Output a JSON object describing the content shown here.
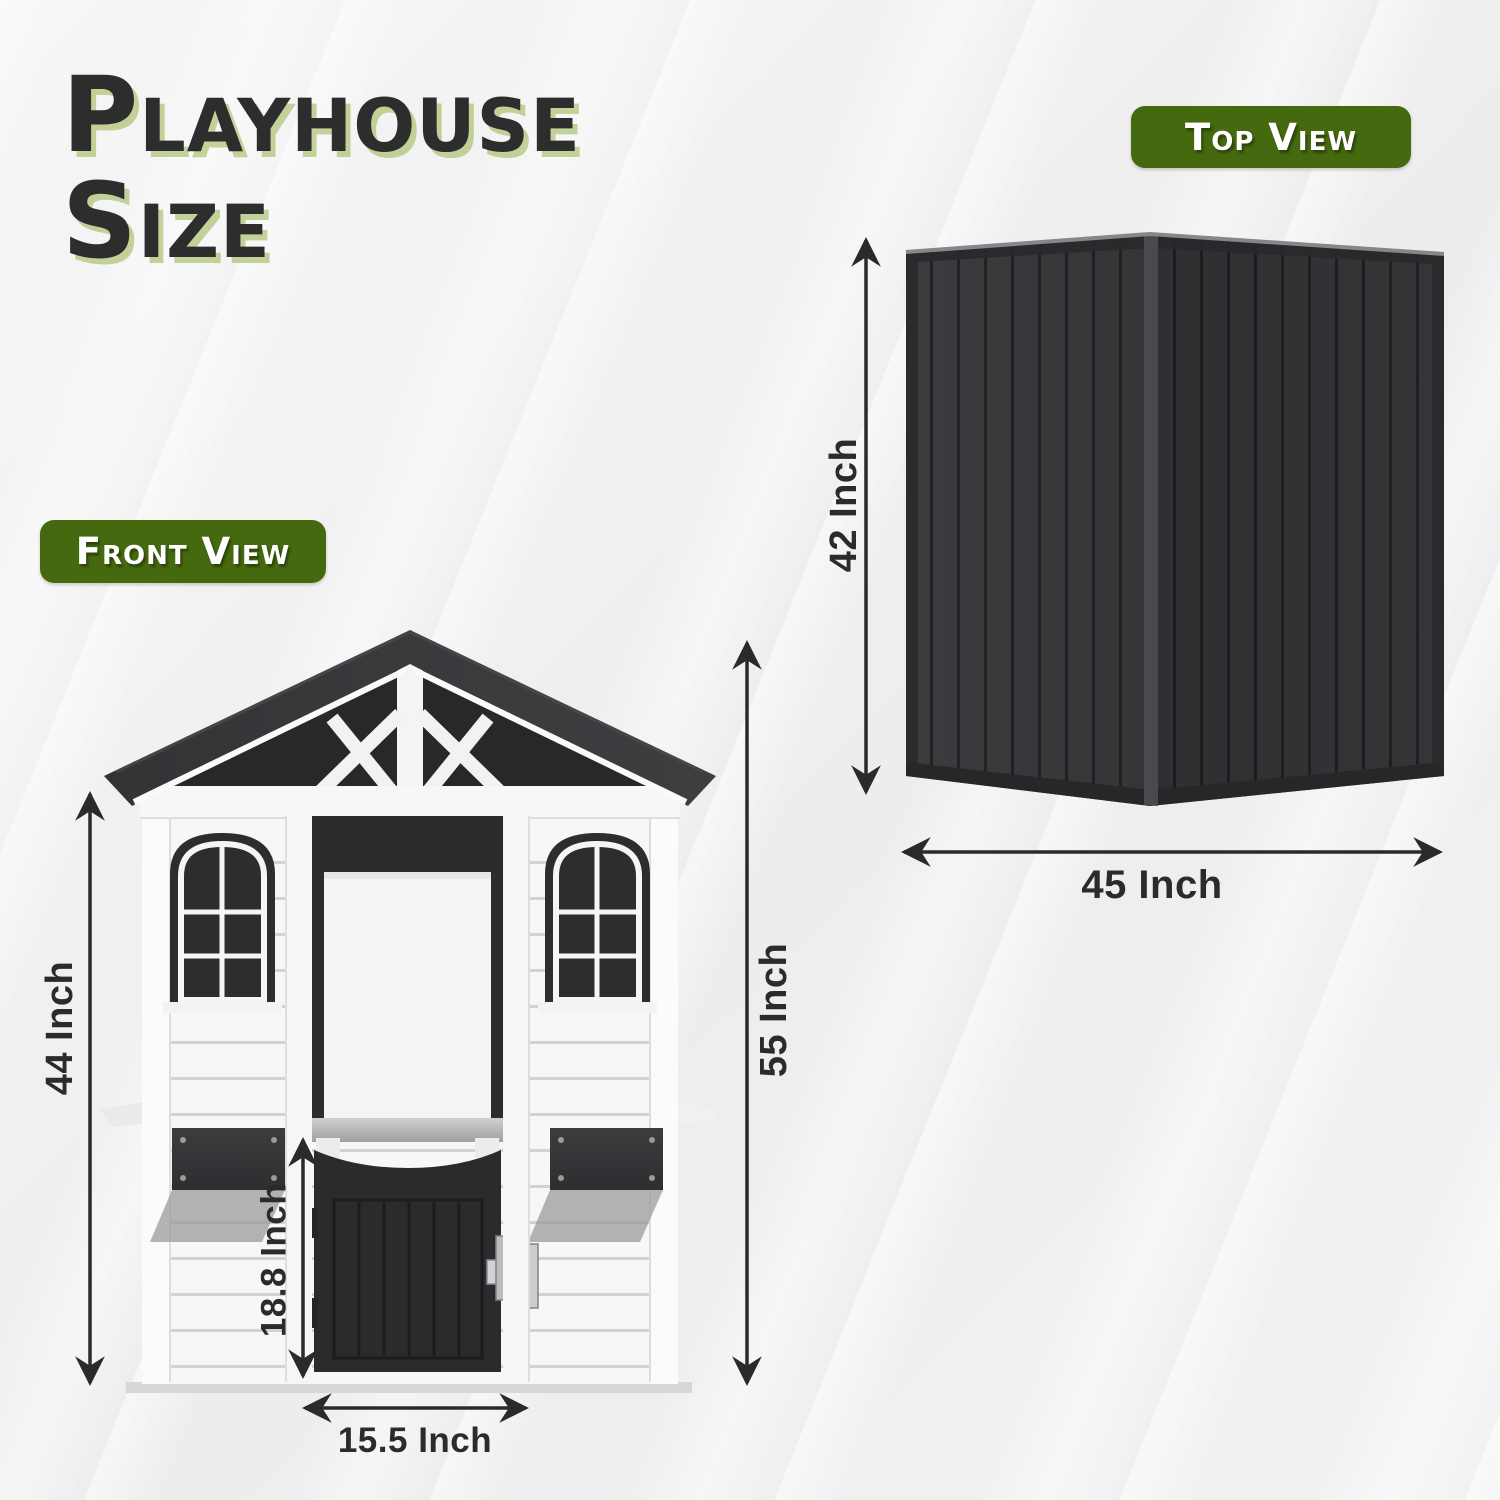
{
  "title": {
    "line1": "Playhouse",
    "line2": "Size"
  },
  "badges": {
    "front_view": "Front View",
    "top_view": "Top View"
  },
  "front_view": {
    "name": "playhouse front view illustration",
    "wall_height_label": "44 Inch",
    "overall_height_label": "55 Inch",
    "door_height_label": "18.8 Inch",
    "door_width_label": "15.5 Inch"
  },
  "top_view": {
    "name": "playhouse top view illustration",
    "depth_label": "42 Inch",
    "width_label": "45 Inch"
  },
  "colors": {
    "badge_green": "#45690f",
    "title_ink": "#2d2d2e",
    "title_shadow_green": "#96b24a",
    "dimension_ink": "#2b2b2b",
    "roof_dark": "#353538",
    "door_dark": "#2b2b2e",
    "wall_white": "#f7f7f8",
    "background": "#f0f0f1"
  }
}
